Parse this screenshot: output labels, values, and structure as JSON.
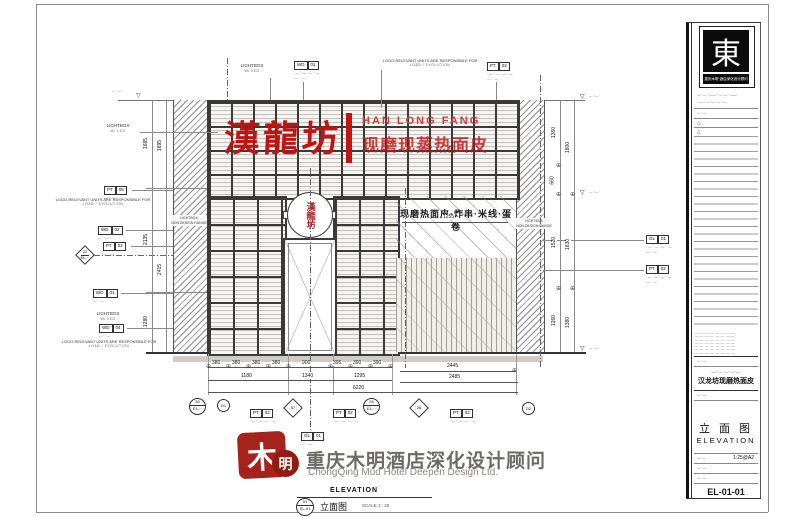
{
  "signage": {
    "main_cn": "漢龍坊",
    "latin": "HAN LONG FANG",
    "sub_cn": "现磨现蒸热面皮",
    "door_circle_cn": "漢龍坊",
    "menu_cn": "现磨热面皮·炸串·米线·蛋卷"
  },
  "notes": {
    "logo_resp1": "LOGO-RELEVANT UNITS ARE RESPONSIBLE FOR",
    "logo_resp2": "LOAD / EVOLUTION",
    "lightbox1": "LIGHTBOX",
    "lightbox2": "W/ LED",
    "non_design1": "LIGHTBOX",
    "non_design2": "NON DESIGN RANGE",
    "micro": "·—··—·—··—",
    "micro2": "—··—·",
    "level": "—·—·"
  },
  "tags": {
    "pt05": [
      "PT",
      "05"
    ],
    "pt02": [
      "PT",
      "02"
    ],
    "wd01": [
      "WD",
      "01"
    ],
    "wd02": [
      "WD",
      "02"
    ],
    "wd04": [
      "WD",
      "04"
    ],
    "gl01": [
      "GL",
      "01"
    ]
  },
  "bubbles": {
    "d22": "22",
    "c30": "30",
    "cd1": "D1",
    "d57": "57",
    "c26": "26",
    "d26": "26",
    "cd2": "D2",
    "sub": "EL-··"
  },
  "dims": {
    "left_inner": [
      "1685",
      "2135",
      "1280"
    ],
    "left_outer": [
      "1695",
      "2415"
    ],
    "right_inner": [
      "1360",
      "660",
      "1520",
      "1260"
    ],
    "right_outer": [
      "1800",
      "1630",
      "1380"
    ],
    "b1": [
      "380",
      "380",
      "380",
      "380",
      "900",
      "395",
      "390",
      "390",
      "2445"
    ],
    "b2": [
      "1180",
      "1340",
      "1295",
      "2485"
    ],
    "total": "6220",
    "menu_width": "1255"
  },
  "view": {
    "en": "ELEVATION",
    "cn": "立面图",
    "scale": "SCALE 1 : 25",
    "num": "01",
    "ref": "EL-01"
  },
  "footer": {
    "cn": "重庆木明酒店深化设计顾问",
    "en": "ChongQing Mud Hotel Deepen Design Ltd.",
    "seal_main": "木",
    "seal_circle": "明"
  },
  "title_block": {
    "logo_char": "東",
    "logo_sub": "重庆木明·酒店深化设计顾问",
    "addr1": "—··—··——···—·—··——·",
    "addr2": "·——·—··—·—··—",
    "rev_mark": "△",
    "note": "—·—··—·—··—·—··—·—·",
    "proj_small": "·—··—·—··—·—·",
    "proj": "汉龙坊现磨热面皮",
    "title_cn": "立 面 图",
    "title_en": "ELEVATION",
    "scale": "1:25@A2",
    "no": "EL-01-01"
  }
}
